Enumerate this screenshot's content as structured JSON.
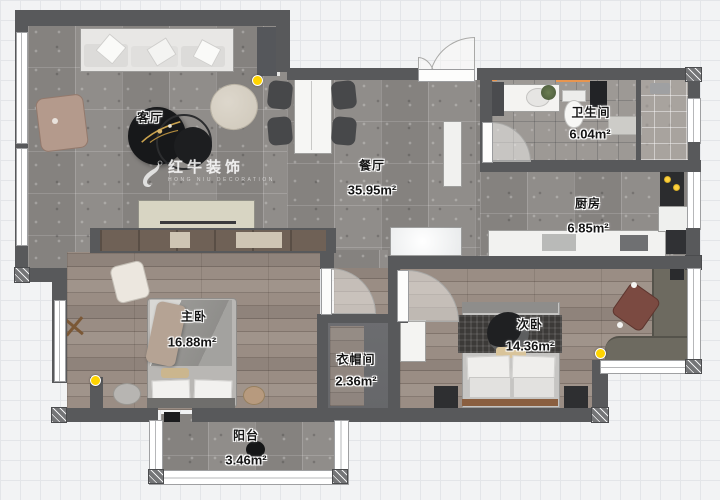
{
  "plan": {
    "watermark": {
      "brand": "红牛装饰",
      "subtitle": "HONG NIU DECORATION"
    },
    "rooms": [
      {
        "id": "living",
        "name": "客厅",
        "area": ""
      },
      {
        "id": "dining",
        "name": "餐厅",
        "area": "35.95m²"
      },
      {
        "id": "bathroom",
        "name": "卫生间",
        "area": "6.04m²"
      },
      {
        "id": "kitchen",
        "name": "厨房",
        "area": "6.85m²"
      },
      {
        "id": "master",
        "name": "主卧",
        "area": "16.88m²"
      },
      {
        "id": "second",
        "name": "次卧",
        "area": "14.36m²"
      },
      {
        "id": "cloak",
        "name": "衣帽间",
        "area": "2.36m²"
      },
      {
        "id": "balcony",
        "name": "阳台",
        "area": "3.46m²"
      }
    ],
    "colors": {
      "wall": "#58595b",
      "marker": "#ffd400",
      "threshold_accent": "#e8954f"
    }
  }
}
